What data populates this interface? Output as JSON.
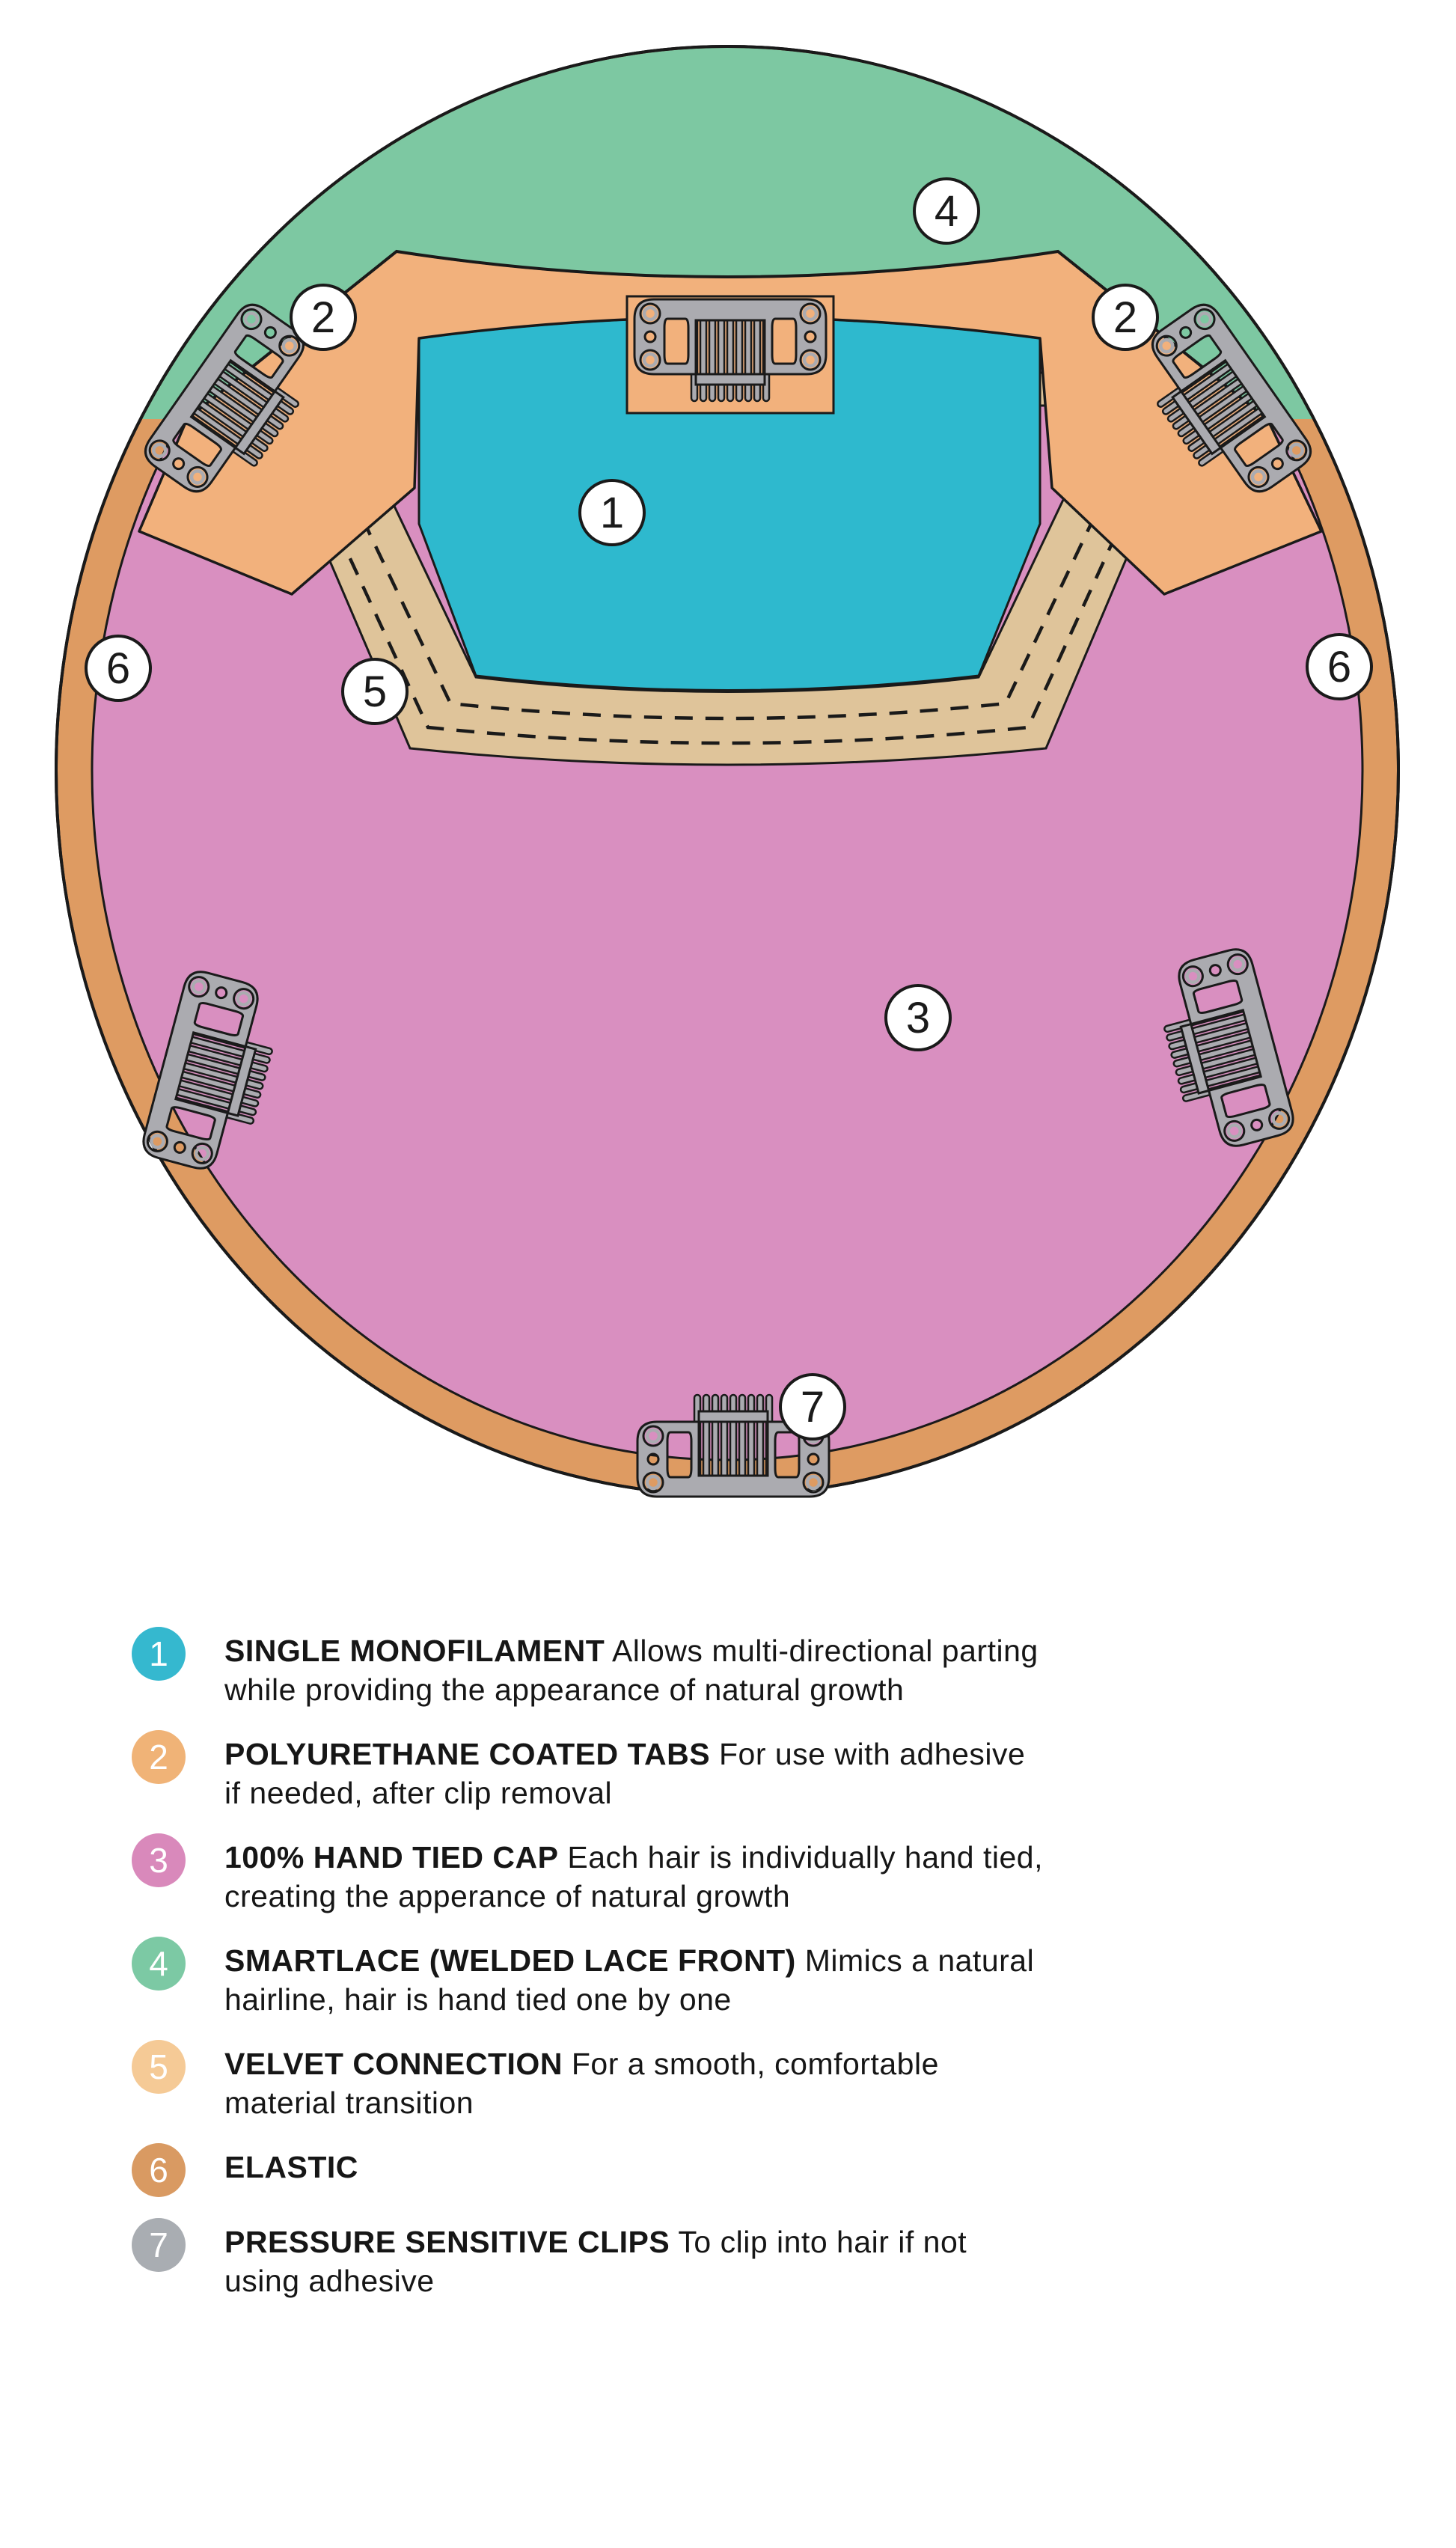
{
  "colors": {
    "monofilament": "#2EB9CE",
    "tabs": "#F2B17C",
    "hand_tied": "#D98FC0",
    "smartlace": "#7DC8A2",
    "velvet": "#DFC49A",
    "elastic": "#DE9B62",
    "clip_gray": "#ABABB0",
    "outline": "#1A1A1A",
    "badge_fill": "#FFFFFF"
  },
  "diagram": {
    "callouts": [
      {
        "label": "4"
      },
      {
        "label": "2"
      },
      {
        "label": "2"
      },
      {
        "label": "1"
      },
      {
        "label": "5"
      },
      {
        "label": "6"
      },
      {
        "label": "6"
      },
      {
        "label": "3"
      },
      {
        "label": "7"
      }
    ]
  },
  "legend": {
    "items": [
      {
        "num": "1",
        "color": "#35B8CF",
        "term": "SINGLE MONOFILAMENT",
        "desc1": "Allows multi-directional parting",
        "desc2": "while providing the appearance of natural growth"
      },
      {
        "num": "2",
        "color": "#F0B377",
        "term": "POLYURETHANE COATED TABS",
        "desc1": "For use with adhesive",
        "desc2": "if needed, after clip removal"
      },
      {
        "num": "3",
        "color": "#D989BB",
        "term": "100% HAND TIED CAP",
        "desc1": "Each hair is individually hand tied,",
        "desc2": "creating the apperance of natural growth"
      },
      {
        "num": "4",
        "color": "#7CC9A4",
        "term": "SMARTLACE (WELDED LACE FRONT)",
        "desc1": "Mimics a natural",
        "desc2": "hairline, hair is hand tied one by one"
      },
      {
        "num": "5",
        "color": "#F5CA96",
        "term": "VELVET CONNECTION",
        "desc1": "For a smooth, comfortable",
        "desc2": "material transition"
      },
      {
        "num": "6",
        "color": "#D99A62",
        "term": "ELASTIC",
        "desc1": "",
        "desc2": ""
      },
      {
        "num": "7",
        "color": "#A9ADB2",
        "term": "PRESSURE SENSITIVE CLIPS",
        "desc1": "To clip into hair if not",
        "desc2": "using adhesive"
      }
    ]
  }
}
